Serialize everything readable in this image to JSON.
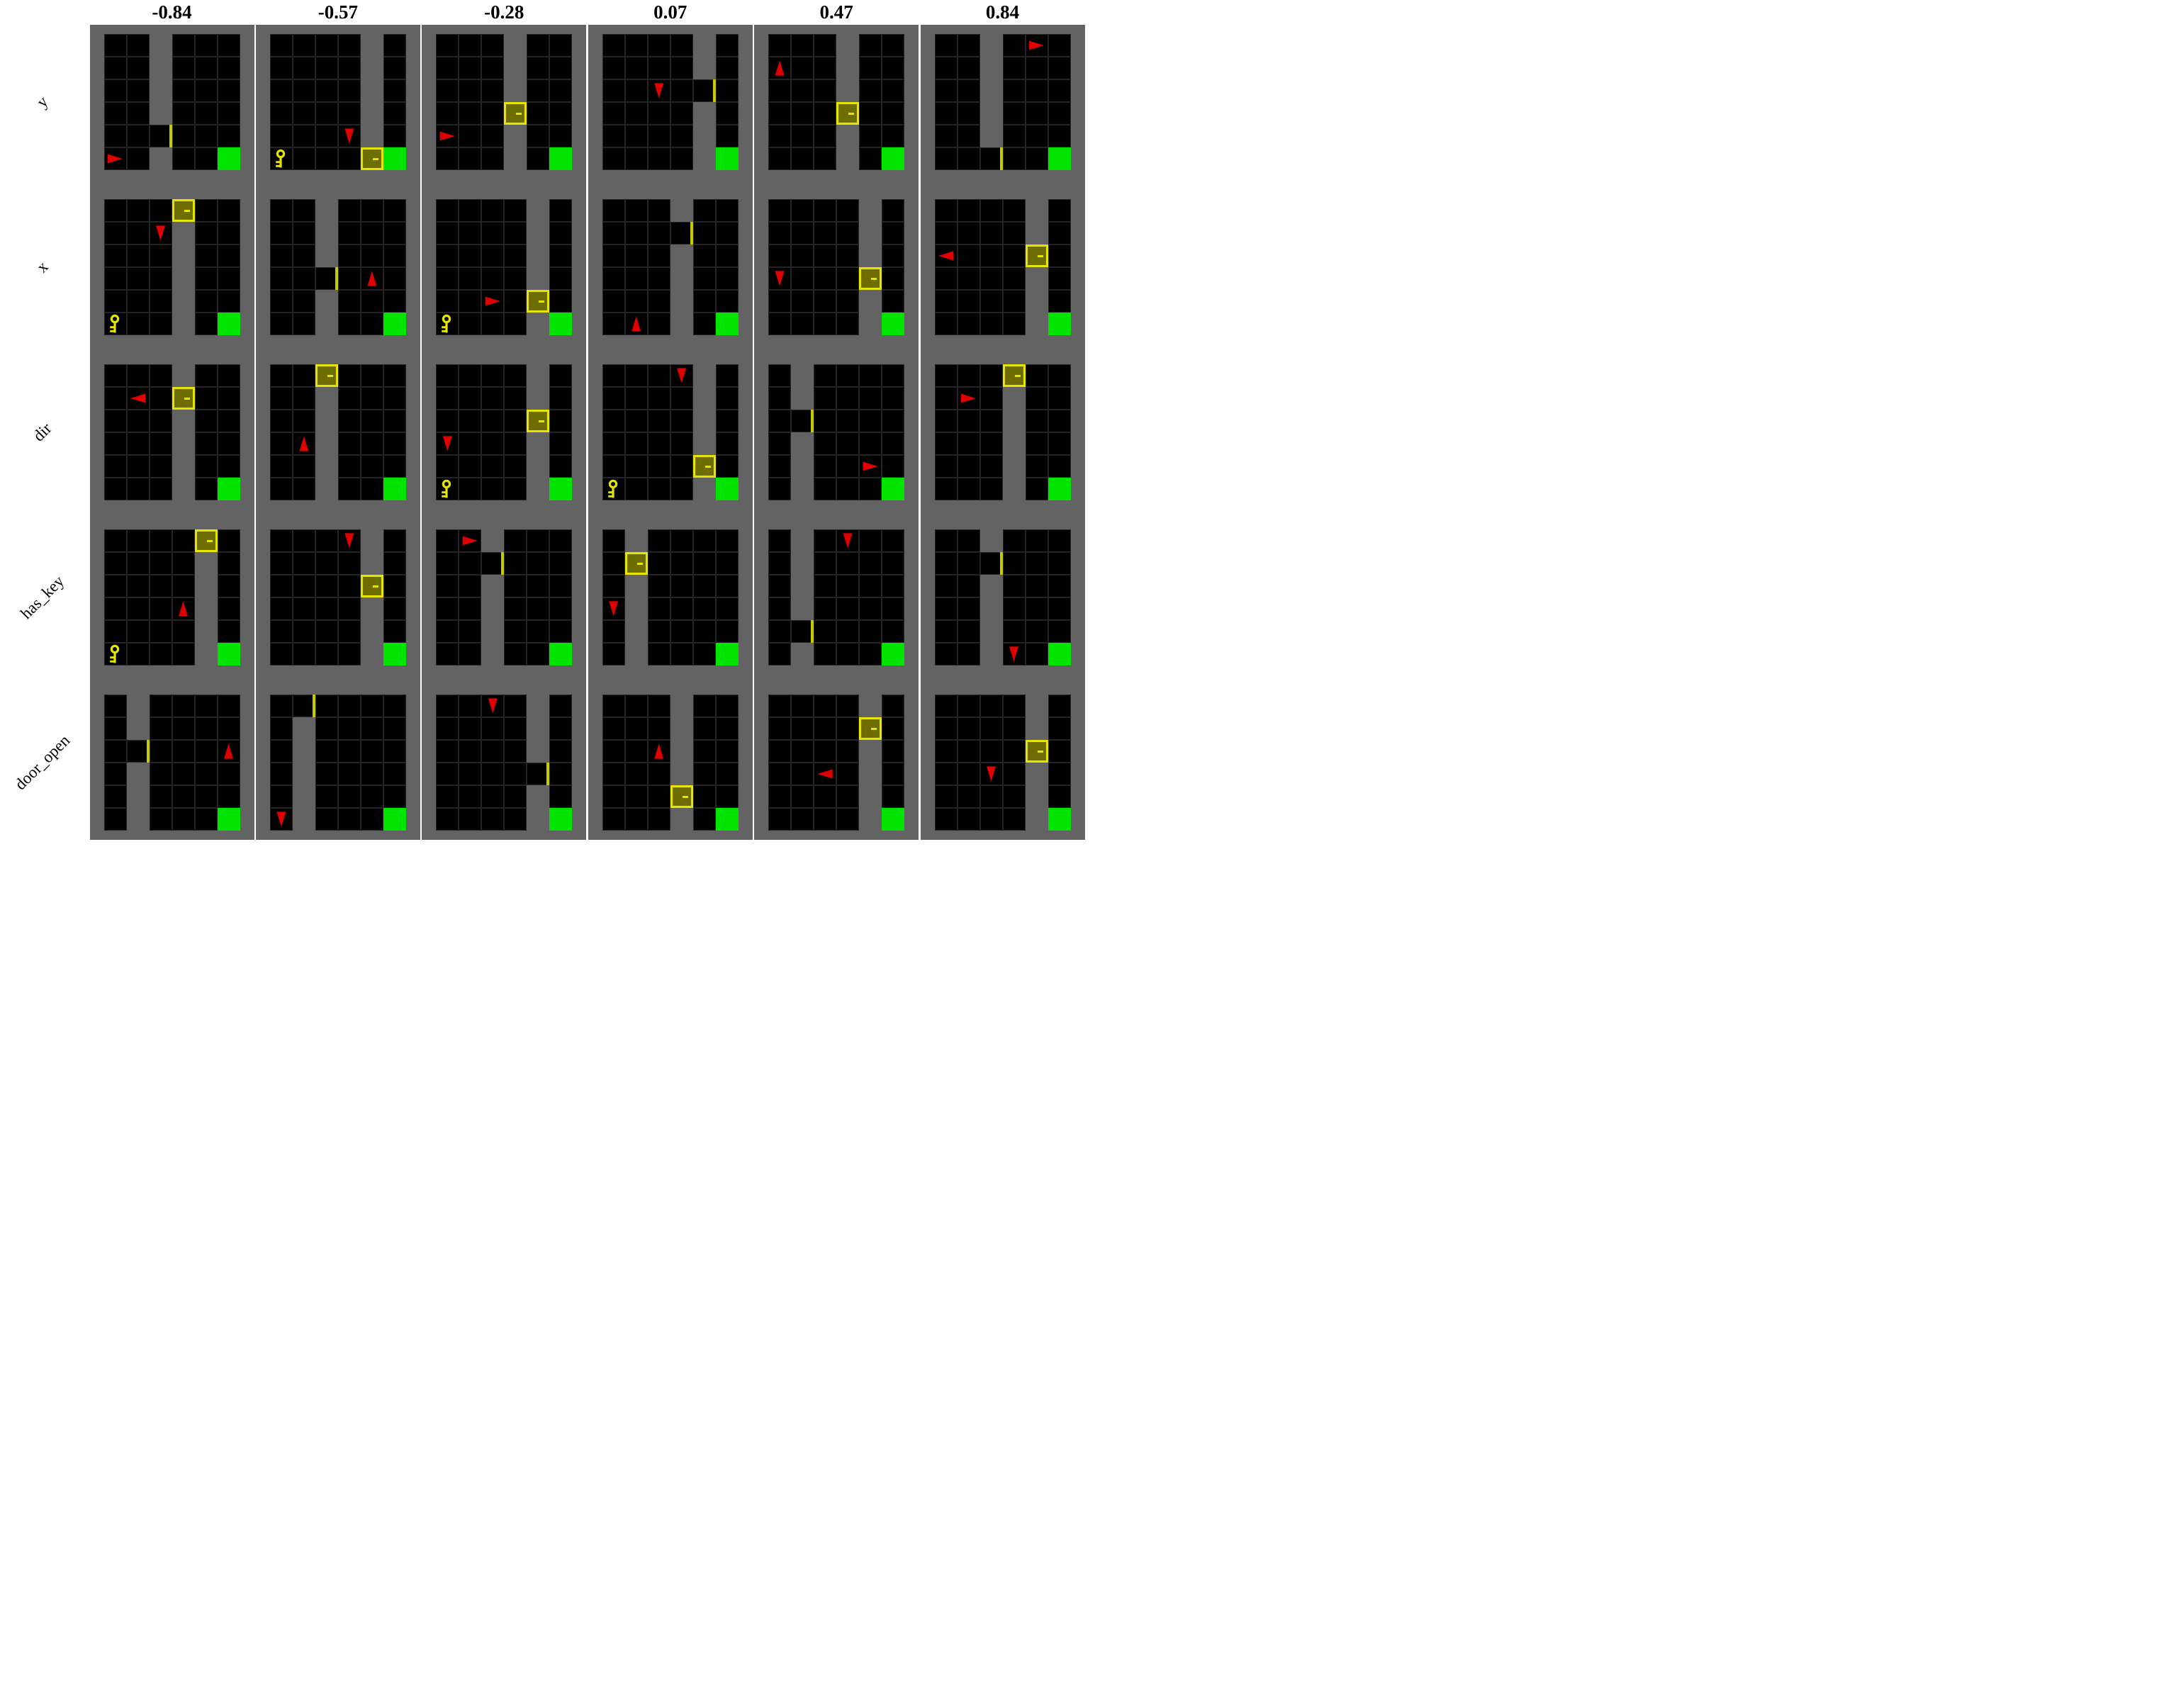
{
  "figure": {
    "col_headers": [
      "-0.84",
      "-0.57",
      "-0.28",
      "0.07",
      "0.47",
      "0.84"
    ],
    "row_labels": [
      "y",
      "x",
      "dir",
      "has_key",
      "door_open"
    ],
    "grid_size": 6,
    "rows": [
      {
        "label": "y",
        "envs": [
          {
            "wall": 2,
            "door": {
              "col": 2,
              "row": 4,
              "open": true
            },
            "agent": {
              "col": 0,
              "row": 5,
              "dir": "right"
            },
            "key": null,
            "goal": {
              "col": 5,
              "row": 5
            }
          },
          {
            "wall": 4,
            "door": {
              "col": 4,
              "row": 5,
              "open": false
            },
            "agent": {
              "col": 3,
              "row": 4,
              "dir": "down"
            },
            "key": {
              "col": 0,
              "row": 5
            },
            "goal": {
              "col": 5,
              "row": 5
            }
          },
          {
            "wall": 3,
            "door": {
              "col": 3,
              "row": 3,
              "open": false
            },
            "agent": {
              "col": 0,
              "row": 4,
              "dir": "right"
            },
            "key": null,
            "goal": {
              "col": 5,
              "row": 5
            }
          },
          {
            "wall": 4,
            "door": {
              "col": 4,
              "row": 2,
              "open": true
            },
            "agent": {
              "col": 2,
              "row": 2,
              "dir": "down"
            },
            "key": null,
            "goal": {
              "col": 5,
              "row": 5
            }
          },
          {
            "wall": 3,
            "door": {
              "col": 3,
              "row": 3,
              "open": false
            },
            "agent": {
              "col": 0,
              "row": 1,
              "dir": "up"
            },
            "key": null,
            "goal": {
              "col": 5,
              "row": 5
            }
          },
          {
            "wall": 2,
            "door": {
              "col": 2,
              "row": 5,
              "open": true
            },
            "agent": {
              "col": 4,
              "row": 0,
              "dir": "right"
            },
            "key": null,
            "goal": {
              "col": 5,
              "row": 5
            }
          }
        ]
      },
      {
        "label": "x",
        "envs": [
          {
            "wall": 3,
            "door": {
              "col": 3,
              "row": 0,
              "open": false
            },
            "agent": {
              "col": 2,
              "row": 1,
              "dir": "down"
            },
            "key": {
              "col": 0,
              "row": 5
            },
            "goal": {
              "col": 5,
              "row": 5
            }
          },
          {
            "wall": 2,
            "door": {
              "col": 2,
              "row": 3,
              "open": true
            },
            "agent": {
              "col": 4,
              "row": 3,
              "dir": "up"
            },
            "key": null,
            "goal": {
              "col": 5,
              "row": 5
            }
          },
          {
            "wall": 4,
            "door": {
              "col": 4,
              "row": 4,
              "open": false
            },
            "agent": {
              "col": 2,
              "row": 4,
              "dir": "right"
            },
            "key": {
              "col": 0,
              "row": 5
            },
            "goal": {
              "col": 5,
              "row": 5
            }
          },
          {
            "wall": 3,
            "door": {
              "col": 3,
              "row": 1,
              "open": true
            },
            "agent": {
              "col": 1,
              "row": 5,
              "dir": "up"
            },
            "key": null,
            "goal": {
              "col": 5,
              "row": 5
            }
          },
          {
            "wall": 4,
            "door": {
              "col": 4,
              "row": 3,
              "open": false
            },
            "agent": {
              "col": 0,
              "row": 3,
              "dir": "down"
            },
            "key": null,
            "goal": {
              "col": 5,
              "row": 5
            }
          },
          {
            "wall": 4,
            "door": {
              "col": 4,
              "row": 2,
              "open": false
            },
            "agent": {
              "col": 0,
              "row": 2,
              "dir": "left"
            },
            "key": null,
            "goal": {
              "col": 5,
              "row": 5
            }
          }
        ]
      },
      {
        "label": "dir",
        "envs": [
          {
            "wall": 3,
            "door": {
              "col": 3,
              "row": 1,
              "open": false
            },
            "agent": {
              "col": 1,
              "row": 1,
              "dir": "left"
            },
            "key": null,
            "goal": {
              "col": 5,
              "row": 5
            }
          },
          {
            "wall": 2,
            "door": {
              "col": 2,
              "row": 0,
              "open": false
            },
            "agent": {
              "col": 1,
              "row": 3,
              "dir": "up"
            },
            "key": null,
            "goal": {
              "col": 5,
              "row": 5
            }
          },
          {
            "wall": 4,
            "door": {
              "col": 4,
              "row": 2,
              "open": false
            },
            "agent": {
              "col": 0,
              "row": 3,
              "dir": "down"
            },
            "key": {
              "col": 0,
              "row": 5
            },
            "goal": {
              "col": 5,
              "row": 5
            }
          },
          {
            "wall": 4,
            "door": {
              "col": 4,
              "row": 4,
              "open": false
            },
            "agent": {
              "col": 3,
              "row": 0,
              "dir": "down"
            },
            "key": {
              "col": 0,
              "row": 5
            },
            "goal": {
              "col": 5,
              "row": 5
            }
          },
          {
            "wall": 1,
            "door": {
              "col": 1,
              "row": 2,
              "open": true
            },
            "agent": {
              "col": 4,
              "row": 4,
              "dir": "right"
            },
            "key": null,
            "goal": {
              "col": 5,
              "row": 5
            }
          },
          {
            "wall": 3,
            "door": {
              "col": 3,
              "row": 0,
              "open": false
            },
            "agent": {
              "col": 1,
              "row": 1,
              "dir": "right"
            },
            "key": null,
            "goal": {
              "col": 5,
              "row": 5
            }
          }
        ]
      },
      {
        "label": "has_key",
        "envs": [
          {
            "wall": 4,
            "door": {
              "col": 4,
              "row": 0,
              "open": false
            },
            "agent": {
              "col": 3,
              "row": 3,
              "dir": "up"
            },
            "key": {
              "col": 0,
              "row": 5
            },
            "goal": {
              "col": 5,
              "row": 5
            }
          },
          {
            "wall": 4,
            "door": {
              "col": 4,
              "row": 2,
              "open": false
            },
            "agent": {
              "col": 3,
              "row": 0,
              "dir": "down"
            },
            "key": null,
            "goal": {
              "col": 5,
              "row": 5
            }
          },
          {
            "wall": 2,
            "door": {
              "col": 2,
              "row": 1,
              "open": true
            },
            "agent": {
              "col": 1,
              "row": 0,
              "dir": "right"
            },
            "key": null,
            "goal": {
              "col": 5,
              "row": 5
            }
          },
          {
            "wall": 1,
            "door": {
              "col": 1,
              "row": 1,
              "open": false
            },
            "agent": {
              "col": 0,
              "row": 3,
              "dir": "down"
            },
            "key": null,
            "goal": {
              "col": 5,
              "row": 5
            }
          },
          {
            "wall": 1,
            "door": {
              "col": 1,
              "row": 4,
              "open": true
            },
            "agent": {
              "col": 3,
              "row": 0,
              "dir": "down"
            },
            "key": null,
            "goal": {
              "col": 5,
              "row": 5
            }
          },
          {
            "wall": 2,
            "door": {
              "col": 2,
              "row": 1,
              "open": true
            },
            "agent": {
              "col": 3,
              "row": 5,
              "dir": "down"
            },
            "key": null,
            "goal": {
              "col": 5,
              "row": 5
            }
          }
        ]
      },
      {
        "label": "door_open",
        "envs": [
          {
            "wall": 1,
            "door": {
              "col": 1,
              "row": 2,
              "open": true
            },
            "agent": {
              "col": 5,
              "row": 2,
              "dir": "up"
            },
            "key": null,
            "goal": {
              "col": 5,
              "row": 5
            }
          },
          {
            "wall": 1,
            "door": {
              "col": 1,
              "row": 0,
              "open": true
            },
            "agent": {
              "col": 0,
              "row": 5,
              "dir": "down"
            },
            "key": null,
            "goal": {
              "col": 5,
              "row": 5
            }
          },
          {
            "wall": 4,
            "door": {
              "col": 4,
              "row": 3,
              "open": true
            },
            "agent": {
              "col": 2,
              "row": 0,
              "dir": "down"
            },
            "key": null,
            "goal": {
              "col": 5,
              "row": 5
            }
          },
          {
            "wall": 3,
            "door": {
              "col": 3,
              "row": 4,
              "open": false
            },
            "agent": {
              "col": 2,
              "row": 2,
              "dir": "up"
            },
            "key": null,
            "goal": {
              "col": 5,
              "row": 5
            }
          },
          {
            "wall": 4,
            "door": {
              "col": 4,
              "row": 1,
              "open": false
            },
            "agent": {
              "col": 2,
              "row": 3,
              "dir": "left"
            },
            "key": null,
            "goal": {
              "col": 5,
              "row": 5
            }
          },
          {
            "wall": 4,
            "door": {
              "col": 4,
              "row": 2,
              "open": false
            },
            "agent": {
              "col": 2,
              "row": 3,
              "dir": "down"
            },
            "key": null,
            "goal": {
              "col": 5,
              "row": 5
            }
          }
        ]
      }
    ]
  },
  "colors": {
    "background": "#ffffff",
    "wall_gray": "#636363",
    "cell_black": "#000000",
    "grid_line": "#242424",
    "goal_green": "#00e400",
    "agent_red": "#e00000",
    "door_yellow": "#e5e500",
    "door_fill": "#6d6d00",
    "door_sliver": "#c9c900",
    "key_yellow": "#e5e500",
    "text_black": "#000000"
  }
}
